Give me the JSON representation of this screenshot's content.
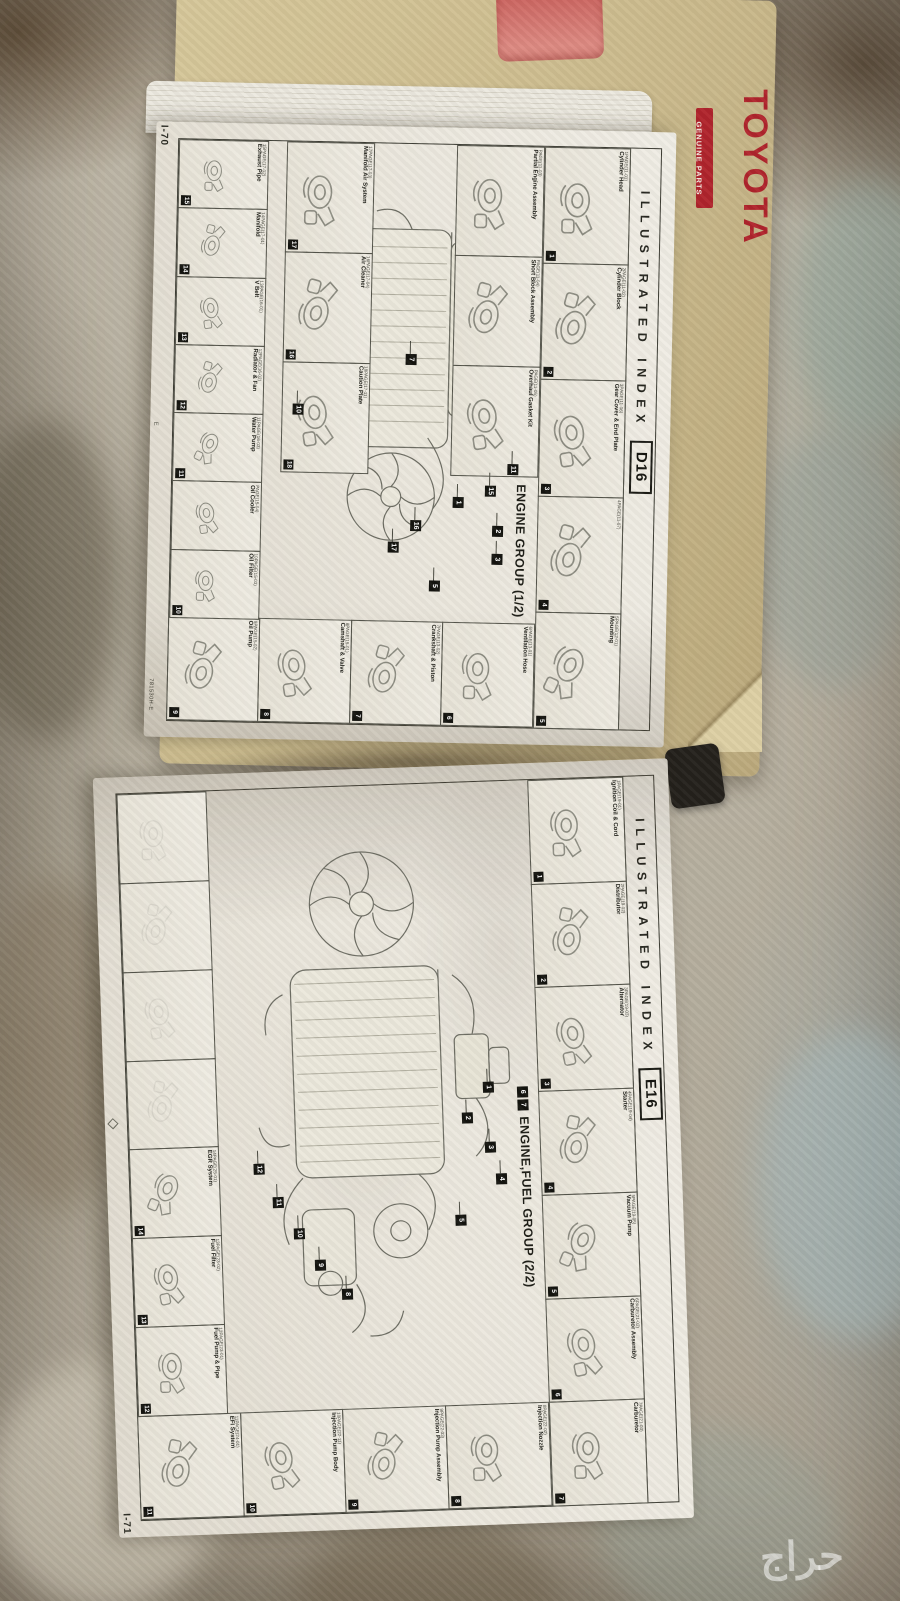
{
  "photo": {
    "watermark_text": "حراج",
    "cover_brand": "TOYOTA",
    "cover_sub": "GENUINE PARTS",
    "colors": {
      "toyota_red": "#b0242c",
      "cover_tan": "#cdbd8f",
      "paper": "#ece8df",
      "carpet": "#b7b0a1"
    }
  },
  "page_top": {
    "page_number": "I-70",
    "header": "ILLUSTRATED INDEX",
    "tab": "D16",
    "title": "ENGINE GROUP (1/2)",
    "footer_code": "781530H-E",
    "footer_code_small": "MA-0706",
    "margin_mark": "E",
    "row_top": [
      {
        "n": "1",
        "edge": "1PAGE(11-01)",
        "label": "Cylinder Head"
      },
      {
        "n": "2",
        "edge": "2PAGE(11-02)",
        "label": "Cylinder Block"
      },
      {
        "n": "3",
        "edge": "3PAGE(11-06)",
        "label": "Gear Cover & End Plate"
      },
      {
        "n": "4",
        "edge": "4PAGE(11-07)",
        "label": ""
      },
      {
        "n": "5",
        "edge": "5PAGE(12-01)",
        "label": "Mounting"
      }
    ],
    "row_assemblies": [
      {
        "n": "",
        "edge": "PAGE(11-03)",
        "label": "Partial Engine Assembly"
      },
      {
        "n": "",
        "edge": "PAGE(11-04)",
        "label": "Short Block Assembly"
      },
      {
        "n": "",
        "edge": "PAGE(11-05)",
        "label": "Overhaul Gasket Kit"
      }
    ],
    "row_intake": [
      {
        "n": "17",
        "edge": "17PAGE(17-03)",
        "label": "Manifold Air System"
      },
      {
        "n": "16",
        "edge": "16PAGE(17-04)",
        "label": "Air Cleaner"
      },
      {
        "n": "18",
        "edge": "18PAGE(17-11)",
        "label": "Caution Plate"
      }
    ],
    "col_right": [
      {
        "n": "6",
        "edge": "6PAGE(13-01)",
        "label": "Ventilation Hose"
      },
      {
        "n": "7",
        "edge": "7PAGE(13-02)",
        "label": "Crankshaft & Piston"
      },
      {
        "n": "8",
        "edge": "8PAGE(15-01)",
        "label": "Camshaft & Valve"
      },
      {
        "n": "9",
        "edge": "9PAGE(15-02)",
        "label": "Oil Pump"
      }
    ],
    "row_bottom": [
      {
        "n": "15",
        "edge": "15PAGE(17-02)",
        "label": "Exhaust Pipe"
      },
      {
        "n": "14",
        "edge": "14PAGE(17-01)",
        "label": "Manifold"
      },
      {
        "n": "13",
        "edge": "13PAGE(16-01)",
        "label": "V Belt"
      },
      {
        "n": "12",
        "edge": "12PAGE(16-02)",
        "label": "Radiator & Fan"
      },
      {
        "n": "11",
        "edge": "11PAGE(16-03)",
        "label": "Water Pump"
      },
      {
        "n": "",
        "edge": "PAGE(15-04)",
        "label": "Oil Cooler"
      },
      {
        "n": "10",
        "edge": "10PAGE(15-03)",
        "label": "Oil Filter"
      }
    ],
    "callouts": [
      "1",
      "2",
      "3",
      "5",
      "7",
      "10",
      "11",
      "15",
      "16",
      "17"
    ]
  },
  "page_bottom": {
    "page_number": "I-71",
    "header": "ILLUSTRATED INDEX",
    "tab": "E16",
    "title": "ENGINE,FUEL GROUP (2/2)",
    "title_callouts": [
      "6",
      "7"
    ],
    "footer_code_small": "MA-1708",
    "row_top": [
      {
        "n": "1",
        "edge": "1PAGE(19-01)",
        "label": "Ignition Coil & Cord"
      },
      {
        "n": "2",
        "edge": "2PAGE(19-02)",
        "label": "Distributor"
      },
      {
        "n": "3",
        "edge": "3PAGE(19-03)",
        "label": "Alternator"
      },
      {
        "n": "4",
        "edge": "4PAGE(19-04)",
        "label": "Starter"
      },
      {
        "n": "5",
        "edge": "5PAGE(19-05)",
        "label": "Vacuum Pump"
      },
      {
        "n": "6",
        "edge": "6PAGE(21-02)",
        "label": "Carburetor Assembly"
      },
      {
        "n": "7",
        "edge": "7PAGE(21-03)",
        "label": "Carburetor"
      }
    ],
    "col_right": [
      {
        "n": "8",
        "edge": "8PAGE(22-02)",
        "label": "Injection Nozzle"
      },
      {
        "n": "9",
        "edge": "9PAGE(22-03)",
        "label": "Injection Pump Assembly"
      },
      {
        "n": "10",
        "edge": "10PAGE(22-11)",
        "label": "Injection Pump Body"
      },
      {
        "n": "11",
        "edge": "11PAGE(24-01)",
        "label": "EFI System"
      }
    ],
    "row_bottom": [
      {
        "ghost": true
      },
      {
        "ghost": true
      },
      {
        "ghost": true
      },
      {
        "ghost": true
      },
      {
        "n": "14",
        "edge": "14PAGE(25-01)",
        "label": "EGR System"
      },
      {
        "n": "13",
        "edge": "13PAGE(23-02)",
        "label": "Fuel Filter"
      },
      {
        "n": "12",
        "edge": "12PAGE(23-01)",
        "label": "Fuel Pump & Pipe"
      }
    ],
    "callouts": [
      "1",
      "2",
      "3",
      "4",
      "5",
      "8",
      "9",
      "10",
      "11",
      "12"
    ]
  }
}
